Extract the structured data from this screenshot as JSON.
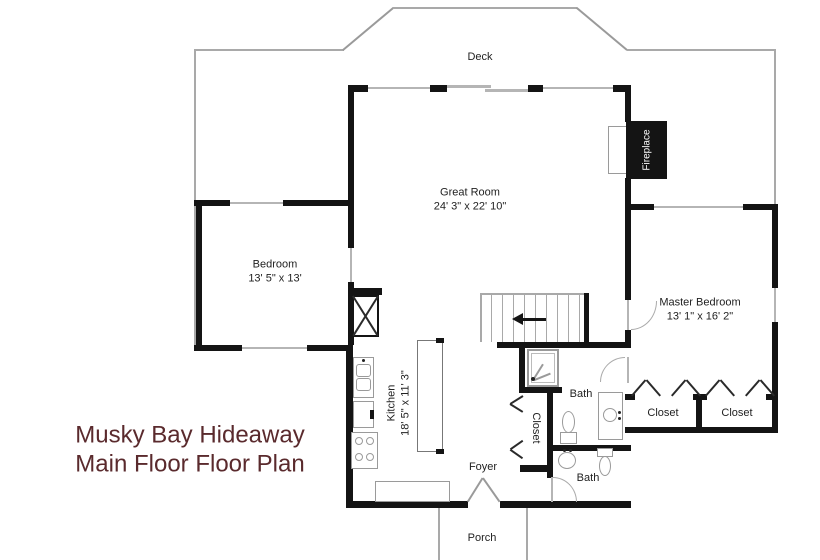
{
  "title": {
    "line1": "Musky Bay Hideaway",
    "line2": "Main Floor Floor Plan"
  },
  "rooms": {
    "deck": {
      "label": "Deck"
    },
    "porch": {
      "label": "Porch"
    },
    "foyer": {
      "label": "Foyer"
    },
    "great_room": {
      "label": "Great Room",
      "dims": "24' 3\" x 22' 10\""
    },
    "bedroom": {
      "label": "Bedroom",
      "dims": "13' 5\" x 13'"
    },
    "master_bedroom": {
      "label": "Master Bedroom",
      "dims": "13' 1\" x 16' 2\""
    },
    "kitchen": {
      "label": "Kitchen",
      "dims": "18' 5\" x 11' 3\""
    },
    "bath_upper": {
      "label": "Bath"
    },
    "bath_lower": {
      "label": "Bath"
    },
    "closet_hall": {
      "label": "Closet"
    },
    "closet_master_left": {
      "label": "Closet"
    },
    "closet_master_right": {
      "label": "Closet"
    },
    "fireplace": {
      "label": "Fireplace"
    }
  },
  "colors": {
    "wall": "#141414",
    "outline": "#a9a9a9",
    "title": "#5a2a2d",
    "label": "#222222",
    "background": "#ffffff"
  }
}
